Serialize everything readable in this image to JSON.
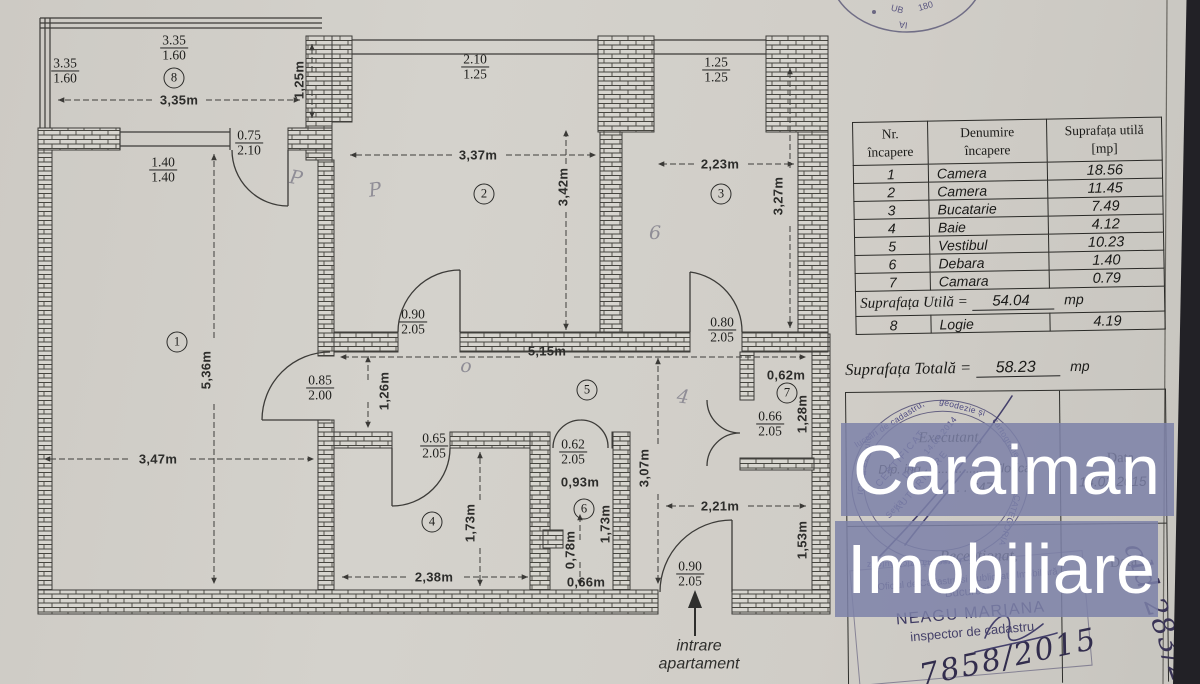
{
  "watermark": {
    "line1": "Caraiman",
    "line2": "Imobiliare",
    "band_color": "rgba(124,129,168,0.85)",
    "text_color": "#ffffff"
  },
  "colors": {
    "paper": "#d2cfc9",
    "ink": "#3c3b38",
    "stamp_ink": "#474370"
  },
  "area_table": {
    "header": {
      "col1a": "Nr.",
      "col1b": "încapere",
      "col2a": "Denumire",
      "col2b": "încapere",
      "col3a": "Suprafața utilă",
      "col3b": "[mp]"
    },
    "rows": [
      {
        "nr": "1",
        "name": "Camera",
        "mp": "18.56"
      },
      {
        "nr": "2",
        "name": "Camera",
        "mp": "11.45"
      },
      {
        "nr": "3",
        "name": "Bucatarie",
        "mp": "7.49"
      },
      {
        "nr": "4",
        "name": "Baie",
        "mp": "4.12"
      },
      {
        "nr": "5",
        "name": "Vestibul",
        "mp": "10.23"
      },
      {
        "nr": "6",
        "name": "Debara",
        "mp": "1.40"
      },
      {
        "nr": "7",
        "name": "Camara",
        "mp": "0.79"
      }
    ],
    "util_label": "Suprafața Utilă =",
    "util_value": "54.04",
    "util_unit": "mp",
    "row8": {
      "nr": "8",
      "name": "Logie",
      "mp": "4.19"
    },
    "total_label": "Suprafața Totală =",
    "total_value": "58.23",
    "total_unit": "mp"
  },
  "cert": {
    "executant_label": "Executant,",
    "executant_line": "Dlp. ing. .................. Florica",
    "executant_no": ". . . . . 647",
    "data_label": "Data",
    "data_value": "14.02.2015",
    "receptionat_label": "Recepționat,",
    "data2_label": "Data",
    "round_stamp": {
      "a1": "ICI să execute",
      "a2": "lucrări de cadastru,",
      "a3": "geodezie și",
      "a4": "cartografie",
      "a5": "CATEGORIA",
      "a6": "Persoană fizică autoriz",
      "c1": "CERTIFICAT",
      "c2": "DE",
      "c3": "AUTORIZARE",
      "c4": "14.04.2014",
      "c5": "Seria"
    },
    "rect_stamp": {
      "l1": "Oficiul de Cadastru si Publicitate Imobiliară",
      "l2": "Bucuresti",
      "l3": "NEAGU MARIANA",
      "l4": "inspector de cadastru"
    },
    "handwritten_number": "7858/2015",
    "margin_note": "ald 283/20"
  },
  "corner_stamp": {
    "f1": "UB",
    "f2": "180",
    "f3": "IA"
  },
  "plan": {
    "entrance_line1": "intrare",
    "entrance_line2": "apartament",
    "rooms": [
      {
        "n": "1",
        "x": 177,
        "y": 342
      },
      {
        "n": "2",
        "x": 484,
        "y": 194
      },
      {
        "n": "3",
        "x": 721,
        "y": 194
      },
      {
        "n": "4",
        "x": 432,
        "y": 522
      },
      {
        "n": "5",
        "x": 587,
        "y": 390
      },
      {
        "n": "6",
        "x": 584,
        "y": 509
      },
      {
        "n": "7",
        "x": 787,
        "y": 393
      },
      {
        "n": "8",
        "x": 174,
        "y": 78
      }
    ],
    "dims": [
      {
        "t": "3,35m",
        "x": 179,
        "y": 100,
        "r": 0
      },
      {
        "t": "1,25m",
        "x": 299,
        "y": 80,
        "r": -90
      },
      {
        "t": "3,37m",
        "x": 478,
        "y": 155,
        "r": 0
      },
      {
        "t": "3,42m",
        "x": 563,
        "y": 187,
        "r": -90
      },
      {
        "t": "2,23m",
        "x": 720,
        "y": 164,
        "r": 0
      },
      {
        "t": "3,27m",
        "x": 778,
        "y": 196,
        "r": -90
      },
      {
        "t": "5,36m",
        "x": 206,
        "y": 370,
        "r": -90
      },
      {
        "t": "3,47m",
        "x": 158,
        "y": 459,
        "r": 0
      },
      {
        "t": "5,15m",
        "x": 547,
        "y": 351,
        "r": 0
      },
      {
        "t": "1,26m",
        "x": 384,
        "y": 391,
        "r": -90
      },
      {
        "t": "0,62m",
        "x": 786,
        "y": 375,
        "r": 0
      },
      {
        "t": "1,28m",
        "x": 802,
        "y": 414,
        "r": -90
      },
      {
        "t": "3,07m",
        "x": 644,
        "y": 468,
        "r": -90
      },
      {
        "t": "0,93m",
        "x": 580,
        "y": 482,
        "r": 0
      },
      {
        "t": "1,73m",
        "x": 470,
        "y": 523,
        "r": -90
      },
      {
        "t": "1,73m",
        "x": 605,
        "y": 524,
        "r": -90
      },
      {
        "t": "0,78m",
        "x": 570,
        "y": 550,
        "r": -90
      },
      {
        "t": "0,66m",
        "x": 586,
        "y": 582,
        "r": 0
      },
      {
        "t": "2,38m",
        "x": 434,
        "y": 577,
        "r": 0
      },
      {
        "t": "2,21m",
        "x": 720,
        "y": 506,
        "r": 0
      },
      {
        "t": "1,53m",
        "x": 802,
        "y": 540,
        "r": -90
      }
    ],
    "fracs": [
      {
        "a": "3.35",
        "b": "1.60",
        "x": 65,
        "y": 71
      },
      {
        "a": "3.35",
        "b": "1.60",
        "x": 174,
        "y": 48
      },
      {
        "a": "0.75",
        "b": "2.10",
        "x": 249,
        "y": 143
      },
      {
        "a": "1.40",
        "b": "1.40",
        "x": 163,
        "y": 170
      },
      {
        "a": "2.10",
        "b": "1.25",
        "x": 475,
        "y": 67
      },
      {
        "a": "1.25",
        "b": "1.25",
        "x": 716,
        "y": 70
      },
      {
        "a": "0.90",
        "b": "2.05",
        "x": 413,
        "y": 322
      },
      {
        "a": "0.80",
        "b": "2.05",
        "x": 722,
        "y": 330
      },
      {
        "a": "0.85",
        "b": "2.00",
        "x": 320,
        "y": 388
      },
      {
        "a": "0.65",
        "b": "2.05",
        "x": 434,
        "y": 446
      },
      {
        "a": "0.62",
        "b": "2.05",
        "x": 573,
        "y": 452
      },
      {
        "a": "0.66",
        "b": "2.05",
        "x": 770,
        "y": 424
      },
      {
        "a": "0.90",
        "b": "2.05",
        "x": 690,
        "y": 574
      }
    ],
    "pencil": [
      {
        "t": "P",
        "x": 296,
        "y": 178,
        "r": 10
      },
      {
        "t": "P",
        "x": 375,
        "y": 190,
        "r": -8
      },
      {
        "t": "6",
        "x": 655,
        "y": 233,
        "r": 0
      },
      {
        "t": "o",
        "x": 466,
        "y": 366,
        "r": 0
      },
      {
        "t": "4",
        "x": 683,
        "y": 397,
        "r": 8
      }
    ]
  }
}
